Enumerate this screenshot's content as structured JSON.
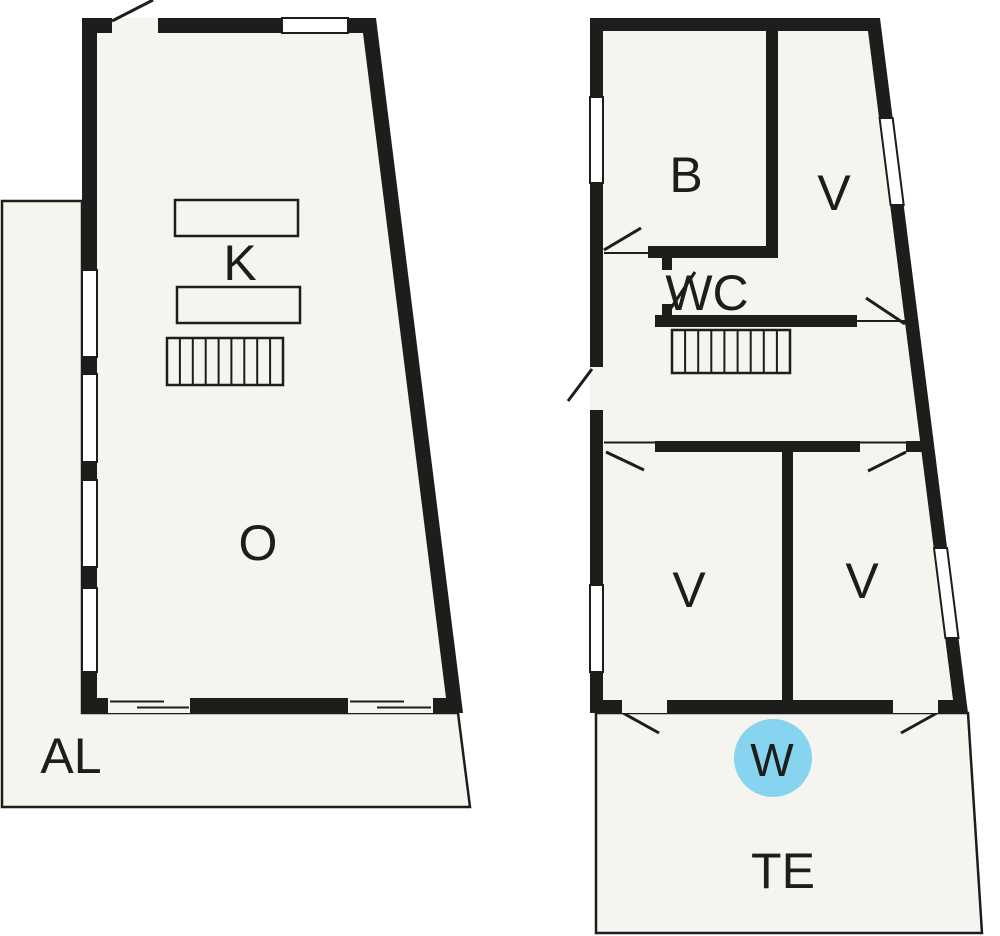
{
  "document": {
    "type": "floor-plan",
    "floors": [
      "ground-floor",
      "upper-floor"
    ]
  },
  "labels": {
    "k": "K",
    "o": "O",
    "al": "AL",
    "b": "B",
    "v_top": "V",
    "wc": "WC",
    "v_bottom_left": "V",
    "v_bottom_right": "V",
    "w": "W",
    "te": "TE"
  },
  "colors": {
    "wall": "#1d1d1b",
    "floor_fill": "#f5f4ee",
    "background": "#ffffff",
    "water_blue": "#87d4f1",
    "label_text": "#1d1d1b"
  }
}
